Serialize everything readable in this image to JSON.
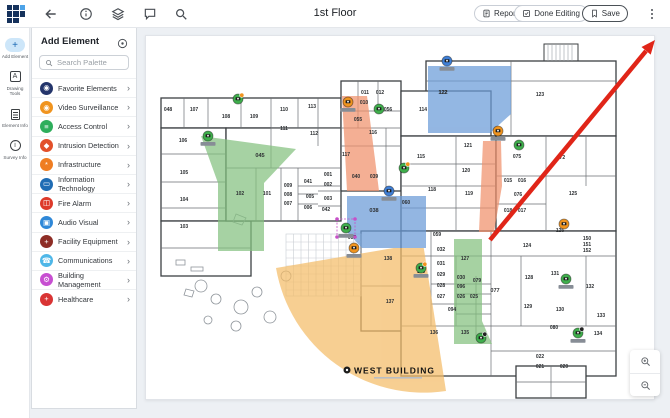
{
  "topbar": {
    "title": "1st Floor",
    "reports": "Reports",
    "done_editing": "Done Editing",
    "save": "Save"
  },
  "rail": {
    "items": [
      {
        "label": "Add Element",
        "active": true
      },
      {
        "label": "Drawing Tools"
      },
      {
        "label": "Element Info"
      },
      {
        "label": "Survey Info"
      }
    ]
  },
  "palette": {
    "title": "Add Element",
    "search_placeholder": "Search Palette",
    "categories": [
      {
        "label": "Favorite Elements",
        "color": "#24356b",
        "glyph": "◉",
        "icon": "camera-icon"
      },
      {
        "label": "Video Surveillance",
        "color": "#f0941f",
        "glyph": "◉",
        "icon": "camera-icon"
      },
      {
        "label": "Access Control",
        "color": "#2eae5c",
        "glyph": "≡",
        "icon": "card-reader-icon"
      },
      {
        "label": "Intrusion Detection",
        "color": "#e2502a",
        "glyph": "◆",
        "icon": "motion-sensor-icon"
      },
      {
        "label": "Infrastructure",
        "color": "#ef7d22",
        "glyph": "*",
        "icon": "conduit-icon"
      },
      {
        "label": "Information Technology",
        "color": "#1f6cb4",
        "glyph": "▭",
        "icon": "monitor-icon"
      },
      {
        "label": "Fire Alarm",
        "color": "#dd3a2a",
        "glyph": "◫",
        "icon": "fire-panel-icon"
      },
      {
        "label": "Audio Visual",
        "color": "#2f88d8",
        "glyph": "▣",
        "icon": "display-icon"
      },
      {
        "label": "Facility Equipment",
        "color": "#8e2d26",
        "glyph": "+",
        "icon": "plus-icon"
      },
      {
        "label": "Communications",
        "color": "#4fb7e8",
        "glyph": "☎",
        "icon": "phone-icon"
      },
      {
        "label": "Building Management",
        "color": "#c74fd1",
        "glyph": "⚙",
        "icon": "gear-icon"
      },
      {
        "label": "Healthcare",
        "color": "#d93434",
        "glyph": "+",
        "icon": "shield-cross-icon"
      }
    ]
  },
  "canvas": {
    "building_name": "WEST BUILDING",
    "zone_colors": {
      "green": "#84c17f",
      "blue": "#6a9bd8",
      "salmon": "#f0916c",
      "orange": "#f4bc68"
    },
    "annotation_arrow_color": "#e02518",
    "rooms": [
      {
        "n": "048",
        "x": 22,
        "y": 75
      },
      {
        "n": "107",
        "x": 48,
        "y": 75
      },
      {
        "n": "108",
        "x": 80,
        "y": 82
      },
      {
        "n": "109",
        "x": 108,
        "y": 82
      },
      {
        "n": "110",
        "x": 138,
        "y": 75
      },
      {
        "n": "113",
        "x": 166,
        "y": 72
      },
      {
        "n": "111",
        "x": 138,
        "y": 94
      },
      {
        "n": "112",
        "x": 168,
        "y": 99
      },
      {
        "n": "106",
        "x": 37,
        "y": 106
      },
      {
        "n": "105",
        "x": 38,
        "y": 138
      },
      {
        "n": "104",
        "x": 38,
        "y": 165
      },
      {
        "n": "103",
        "x": 38,
        "y": 192
      },
      {
        "n": "102",
        "x": 94,
        "y": 159
      },
      {
        "n": "101",
        "x": 121,
        "y": 159
      },
      {
        "n": "009",
        "x": 142,
        "y": 151
      },
      {
        "n": "008",
        "x": 142,
        "y": 160
      },
      {
        "n": "007",
        "x": 142,
        "y": 169
      },
      {
        "n": "041",
        "x": 162,
        "y": 147
      },
      {
        "n": "005",
        "x": 164,
        "y": 162
      },
      {
        "n": "006",
        "x": 162,
        "y": 173
      },
      {
        "n": "001",
        "x": 182,
        "y": 140
      },
      {
        "n": "002",
        "x": 182,
        "y": 150
      },
      {
        "n": "003",
        "x": 182,
        "y": 164
      },
      {
        "n": "042",
        "x": 180,
        "y": 175
      },
      {
        "n": "040",
        "x": 210,
        "y": 142
      },
      {
        "n": "039",
        "x": 228,
        "y": 142
      },
      {
        "n": "116",
        "x": 227,
        "y": 98
      },
      {
        "n": "117",
        "x": 200,
        "y": 120
      },
      {
        "n": "056",
        "x": 242,
        "y": 75
      },
      {
        "n": "011",
        "x": 219,
        "y": 58
      },
      {
        "n": "012",
        "x": 234,
        "y": 58
      },
      {
        "n": "010",
        "x": 218,
        "y": 68
      },
      {
        "n": "055",
        "x": 212,
        "y": 85
      },
      {
        "n": "122",
        "x": 297,
        "y": 58
      },
      {
        "n": "123",
        "x": 394,
        "y": 60
      },
      {
        "n": "114",
        "x": 277,
        "y": 75
      },
      {
        "n": "115",
        "x": 275,
        "y": 122
      },
      {
        "n": "121",
        "x": 322,
        "y": 111
      },
      {
        "n": "120",
        "x": 320,
        "y": 136
      },
      {
        "n": "119",
        "x": 323,
        "y": 159
      },
      {
        "n": "118",
        "x": 286,
        "y": 155
      },
      {
        "n": "060",
        "x": 260,
        "y": 168
      },
      {
        "n": "075",
        "x": 371,
        "y": 122
      },
      {
        "n": "072",
        "x": 415,
        "y": 123
      },
      {
        "n": "076",
        "x": 372,
        "y": 160
      },
      {
        "n": "015",
        "x": 362,
        "y": 146
      },
      {
        "n": "016",
        "x": 376,
        "y": 146
      },
      {
        "n": "018",
        "x": 362,
        "y": 176
      },
      {
        "n": "017",
        "x": 376,
        "y": 176
      },
      {
        "n": "125",
        "x": 427,
        "y": 159
      },
      {
        "n": "059",
        "x": 291,
        "y": 200
      },
      {
        "n": "032",
        "x": 295,
        "y": 215
      },
      {
        "n": "127",
        "x": 319,
        "y": 224
      },
      {
        "n": "031",
        "x": 295,
        "y": 229
      },
      {
        "n": "029",
        "x": 295,
        "y": 240
      },
      {
        "n": "030",
        "x": 315,
        "y": 243
      },
      {
        "n": "079",
        "x": 331,
        "y": 246
      },
      {
        "n": "028",
        "x": 295,
        "y": 251
      },
      {
        "n": "096",
        "x": 315,
        "y": 252
      },
      {
        "n": "027",
        "x": 295,
        "y": 262
      },
      {
        "n": "026",
        "x": 315,
        "y": 262
      },
      {
        "n": "025",
        "x": 328,
        "y": 262
      },
      {
        "n": "100",
        "x": 275,
        "y": 237
      },
      {
        "n": "094",
        "x": 306,
        "y": 275
      },
      {
        "n": "136",
        "x": 288,
        "y": 298
      },
      {
        "n": "135",
        "x": 319,
        "y": 298
      },
      {
        "n": "124",
        "x": 381,
        "y": 211
      },
      {
        "n": "126",
        "x": 414,
        "y": 196
      },
      {
        "n": "150",
        "x": 441,
        "y": 204
      },
      {
        "n": "151",
        "x": 441,
        "y": 210
      },
      {
        "n": "152",
        "x": 441,
        "y": 216
      },
      {
        "n": "128",
        "x": 383,
        "y": 243
      },
      {
        "n": "131",
        "x": 409,
        "y": 239
      },
      {
        "n": "132",
        "x": 444,
        "y": 252
      },
      {
        "n": "129",
        "x": 382,
        "y": 272
      },
      {
        "n": "130",
        "x": 414,
        "y": 275
      },
      {
        "n": "133",
        "x": 455,
        "y": 281
      },
      {
        "n": "134",
        "x": 452,
        "y": 299
      },
      {
        "n": "080",
        "x": 408,
        "y": 293
      },
      {
        "n": "022",
        "x": 394,
        "y": 322
      },
      {
        "n": "021",
        "x": 394,
        "y": 332
      },
      {
        "n": "020",
        "x": 418,
        "y": 332
      },
      {
        "n": "137",
        "x": 244,
        "y": 267
      },
      {
        "n": "138",
        "x": 242,
        "y": 224
      },
      {
        "n": "037",
        "x": 206,
        "y": 203
      }
    ],
    "zone_labels": [
      {
        "n": "045",
        "x": 114,
        "y": 121
      },
      {
        "n": "038",
        "x": 228,
        "y": 176
      },
      {
        "n": "122",
        "x": 297,
        "y": 58
      },
      {
        "n": "077",
        "x": 349,
        "y": 256
      }
    ],
    "devices": [
      {
        "type": "camera-green",
        "x": 62,
        "y": 100,
        "label": true
      },
      {
        "type": "camera-green",
        "x": 92,
        "y": 63,
        "dot": "#f0941f"
      },
      {
        "type": "camera-orange",
        "x": 202,
        "y": 66,
        "label": true
      },
      {
        "type": "camera-green",
        "x": 233,
        "y": 73
      },
      {
        "type": "camera-green",
        "x": 258,
        "y": 132,
        "dot": "#f0941f"
      },
      {
        "type": "camera-blue",
        "x": 243,
        "y": 155,
        "label": true
      },
      {
        "type": "camera-green",
        "x": 200,
        "y": 192,
        "label": true,
        "selected": true
      },
      {
        "type": "camera-orange",
        "x": 208,
        "y": 212,
        "label": true
      },
      {
        "type": "camera-blue",
        "x": 301,
        "y": 25,
        "label": true
      },
      {
        "type": "camera-orange",
        "x": 352,
        "y": 95,
        "label": true
      },
      {
        "type": "camera-green",
        "x": 373,
        "y": 109
      },
      {
        "type": "camera-green",
        "x": 275,
        "y": 232,
        "dot": "#f0941f",
        "label": true
      },
      {
        "type": "camera-green",
        "x": 420,
        "y": 243,
        "label": true
      },
      {
        "type": "camera-green",
        "x": 432,
        "y": 297,
        "dot": "#222222",
        "label": true
      },
      {
        "type": "camera-green",
        "x": 335,
        "y": 302,
        "dot": "#222222"
      },
      {
        "type": "camera-orange",
        "x": 418,
        "y": 188
      }
    ],
    "device_colors": {
      "camera-green": "#3fae4c",
      "camera-orange": "#f0941f",
      "camera-blue": "#3f7fd6"
    },
    "selection_color": "#c650c8"
  }
}
